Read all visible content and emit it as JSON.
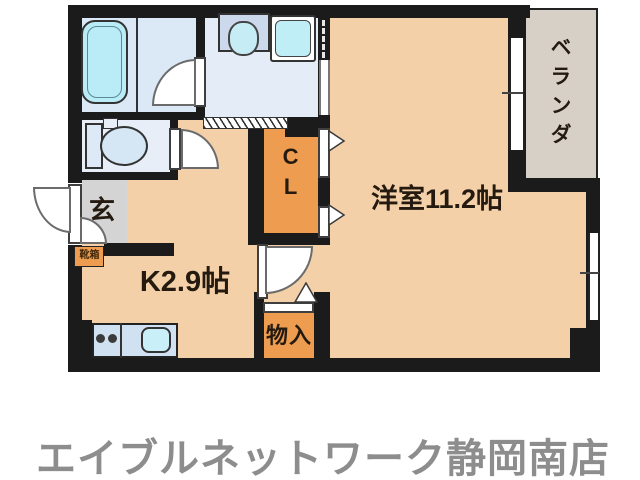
{
  "plan": {
    "rooms": {
      "main_room": {
        "label": "洋室11.2帖"
      },
      "kitchen": {
        "label": "K2.9帖"
      },
      "closet": {
        "label": "CL"
      },
      "storage": {
        "label": "物入"
      },
      "entrance": {
        "label": "玄"
      },
      "shoe_box": {
        "label": "靴箱"
      },
      "veranda": {
        "label": "ベランダ"
      }
    },
    "colors": {
      "room_floor_peach": "#f3d0a7",
      "closet_orange": "#ee9d50",
      "wet_area_blue": "#e1eaf6",
      "fixture_cyan": "#b9ecf6",
      "entrance_gray": "#d4d4d4",
      "veranda_beige": "#d6d0c7",
      "wall_black": "#1b1b1b",
      "store_text_gray": "#8d8d8d"
    }
  },
  "footer": {
    "store_name": "エイブルネットワーク静岡南店"
  }
}
